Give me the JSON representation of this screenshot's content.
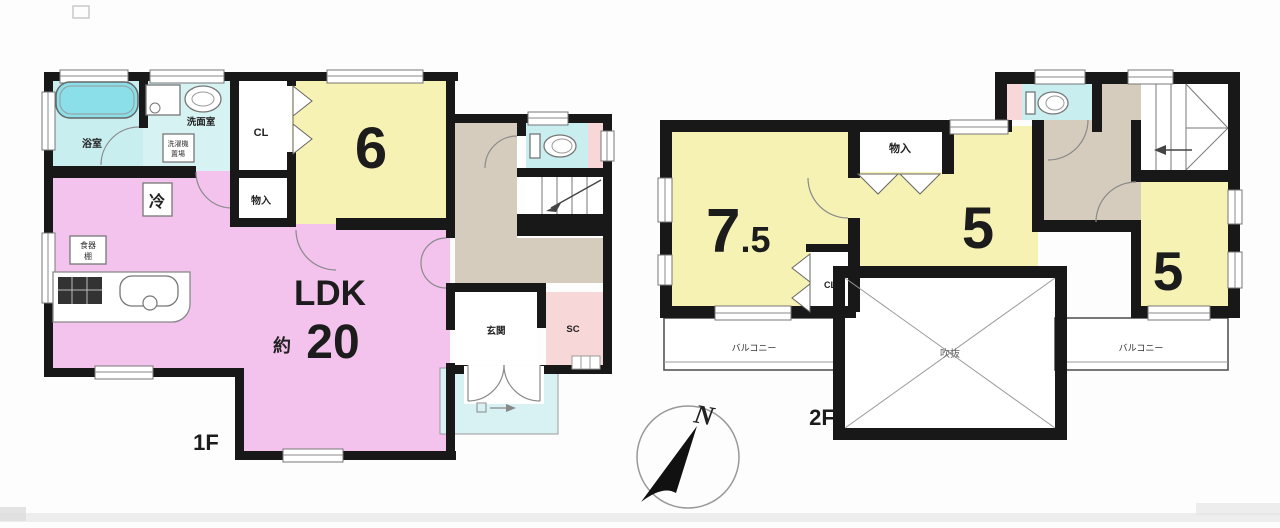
{
  "floor1": {
    "floor_label": "1F",
    "bath_label": "浴室",
    "washroom_label": "洗面室",
    "washer_line1": "洗濯機",
    "washer_line2": "置場",
    "fridge_label": "冷",
    "cupboard_line1": "食器",
    "cupboard_line2": "棚",
    "closet_label": "CL",
    "storage_label": "物入",
    "room6_value": "6",
    "ldk_title": "LDK",
    "ldk_approx": "約",
    "ldk_value": "20",
    "entrance_label": "玄関",
    "shoe_closet_label": "SC"
  },
  "floor2": {
    "floor_label": "2F",
    "room75_int": "7",
    "room75_frac": ".5",
    "storage_label": "物入",
    "room5_center_value": "5",
    "closet_label": "CL",
    "room5_right_value": "5",
    "void_label": "吹抜",
    "balcony_left_label": "バルコニー",
    "balcony_right_label": "バルコニー"
  },
  "compass": {
    "north_label": "N"
  },
  "palette": {
    "wall": "#181818",
    "room_yellow": "#f5f2b3",
    "ldk_pink": "#f3c3ee",
    "water_cyan": "#c9eef0",
    "tub_cyan": "#8adfe8",
    "hall_beige": "#d5ccbd",
    "accent_pink": "#f7d7d7",
    "porch_cyan": "#d8f2f3"
  }
}
